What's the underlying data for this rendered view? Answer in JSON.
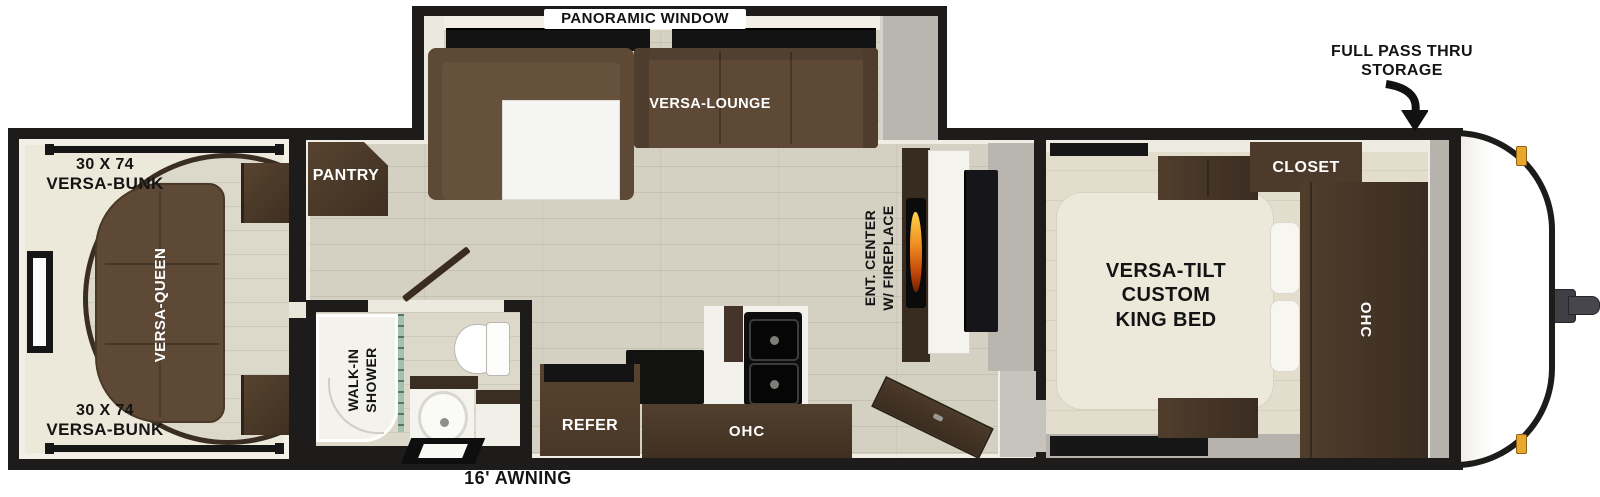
{
  "callouts": {
    "panoramic_window": "PANORAMIC WINDOW",
    "full_pass_thru": {
      "line1": "FULL PASS THRU",
      "line2": "STORAGE"
    },
    "awning": "16' AWNING"
  },
  "rear_bedroom": {
    "bunk_top": {
      "size": "30 X 74",
      "name": "VERSA-BUNK"
    },
    "bunk_bottom": {
      "size": "30 X 74",
      "name": "VERSA-BUNK"
    },
    "queen_bed": "VERSA-QUEEN"
  },
  "slide_out": {
    "lounge": "VERSA-LOUNGE"
  },
  "galley": {
    "pantry": "PANTRY",
    "refrigerator": "REFER",
    "overhead_cabinet": "OHC"
  },
  "bathroom": {
    "shower": {
      "line1": "WALK-IN",
      "line2": "SHOWER"
    }
  },
  "living": {
    "ent_center": {
      "line1": "ENT. CENTER",
      "line2": "W/ FIREPLACE"
    }
  },
  "bedroom": {
    "bed": {
      "line1": "VERSA-TILT",
      "line2": "CUSTOM",
      "line3": "KING BED"
    },
    "closet": "CLOSET",
    "overhead_cabinet": "OHC"
  },
  "colors": {
    "wall": "#1d1c1a",
    "floor": "#d5d1c2",
    "wood_dark": "#3a2d21",
    "wood": "#4e3c2c",
    "sofa": "#5d4936",
    "cream": "#ece8da",
    "flame": "#e8821e",
    "marker_light": "#eaa62d",
    "curtain": "#a3bfad"
  }
}
